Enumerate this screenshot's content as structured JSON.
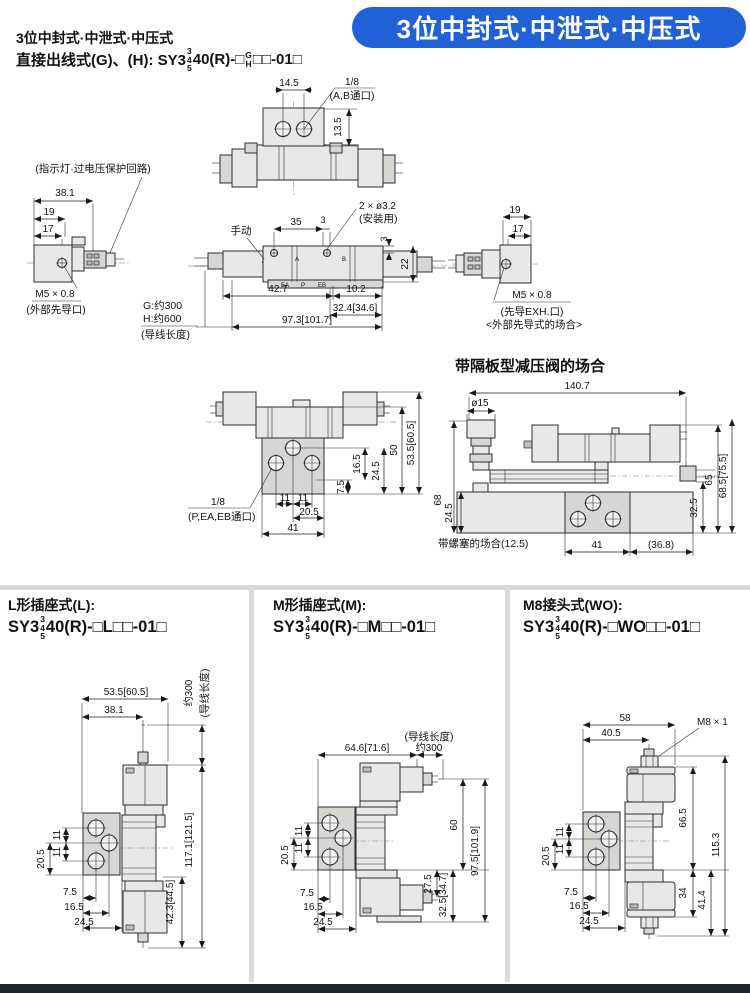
{
  "s345": [
    "3",
    "4",
    "5"
  ],
  "sGH": [
    "G",
    "H"
  ],
  "header": {
    "line1": "3位中封式·中泄式·中压式",
    "line2_pre": "直接出线式(G)、(H): SY3",
    "line2_mid": "40(R)-□",
    "line2_suf": "□□-01□",
    "banner": "3位中封式·中泄式·中压式",
    "banner_color": "#2161d8"
  },
  "s1": {
    "top": {
      "d145": "14.5",
      "port": "1/8",
      "portNote": "(A,B通口)",
      "d135": "13.5"
    },
    "left": {
      "note": "(指示灯·过电压保护回路)",
      "d381": "38.1",
      "d19": "19",
      "d17": "17",
      "thread": "M5 × 0.8",
      "threadNote": "(外部先导口)"
    },
    "lead": {
      "g": "G:约300",
      "h": "H:约600",
      "note": "(导线长度)"
    },
    "front": {
      "manual": "手动",
      "d35": "35",
      "d3a": "3",
      "mount": "2 × ø3.2",
      "mountNote": "(安装用)",
      "d3b": "3",
      "d22": "22",
      "d427": "42.7",
      "d102": "10.2",
      "d324": "32.4[34.6]",
      "d973": "97.3[101.7]",
      "pA": "A",
      "pB": "B",
      "pEA": "EA",
      "pP": "P",
      "pEB": "EB"
    },
    "right": {
      "d19": "19",
      "d17": "17",
      "thread": "M5 × 0.8",
      "threadNote": "(先导EXH.口)",
      "caseNote": "<外部先导式的场合>"
    }
  },
  "s2": {
    "title": "带隔板型减压阀的场合",
    "left": {
      "d75": "7.5",
      "d165": "16.5",
      "d245": "24.5",
      "d50": "50",
      "d535": "53.5[60.5]",
      "d11a": "11",
      "d11b": "11",
      "d205": "20.5",
      "d41": "41",
      "port": "1/8",
      "portNote": "(P,EA,EB通口)"
    },
    "right": {
      "d1407": "140.7",
      "dk": "ø15",
      "d68": "68",
      "d245": "24.5",
      "d325": "32.5",
      "d65": "65",
      "d685": "68.5[75.5]",
      "plugNote": "带螺塞的场合(12.5)",
      "d41": "41",
      "d368": "(36.8)"
    }
  },
  "panels": [
    {
      "title": "L形插座式(L):",
      "mpre": "SY3",
      "mmid": "40(R)-□L□□-01□",
      "d535": "53.5[60.5]",
      "d381": "38.1",
      "wire": "约300",
      "wireNote": "(导线长度)",
      "d11a": "11",
      "d11b": "11",
      "d205": "20.5",
      "d75": "7.5",
      "d165": "16.5",
      "d245": "24.5",
      "dH": "117.1[121.5]",
      "dS": "42.3[44.5]"
    },
    {
      "title": "M形插座式(M):",
      "mpre": "SY3",
      "mmid": "40(R)-□M□□-01□",
      "dW": "64.6[71.6]",
      "wire": "约300",
      "wireNote": "(导线长度)",
      "d11a": "11",
      "d11b": "11",
      "d205": "20.5",
      "d75": "7.5",
      "d165": "16.5",
      "d245": "24.5",
      "d60": "60",
      "dH": "97.5[101.9]",
      "d275": "27.5",
      "dS": "32.5[34.7]"
    },
    {
      "title": "M8接头式(WO):",
      "mpre": "SY3",
      "mmid": "40(R)-□WO□□-01□",
      "d58": "58",
      "d405": "40.5",
      "m8": "M8 × 1",
      "d11a": "11",
      "d11b": "11",
      "d205": "20.5",
      "d75": "7.5",
      "d165": "16.5",
      "d245": "24.5",
      "d665": "66.5",
      "dH": "115.3",
      "d34": "34",
      "d414": "41.4"
    }
  ]
}
